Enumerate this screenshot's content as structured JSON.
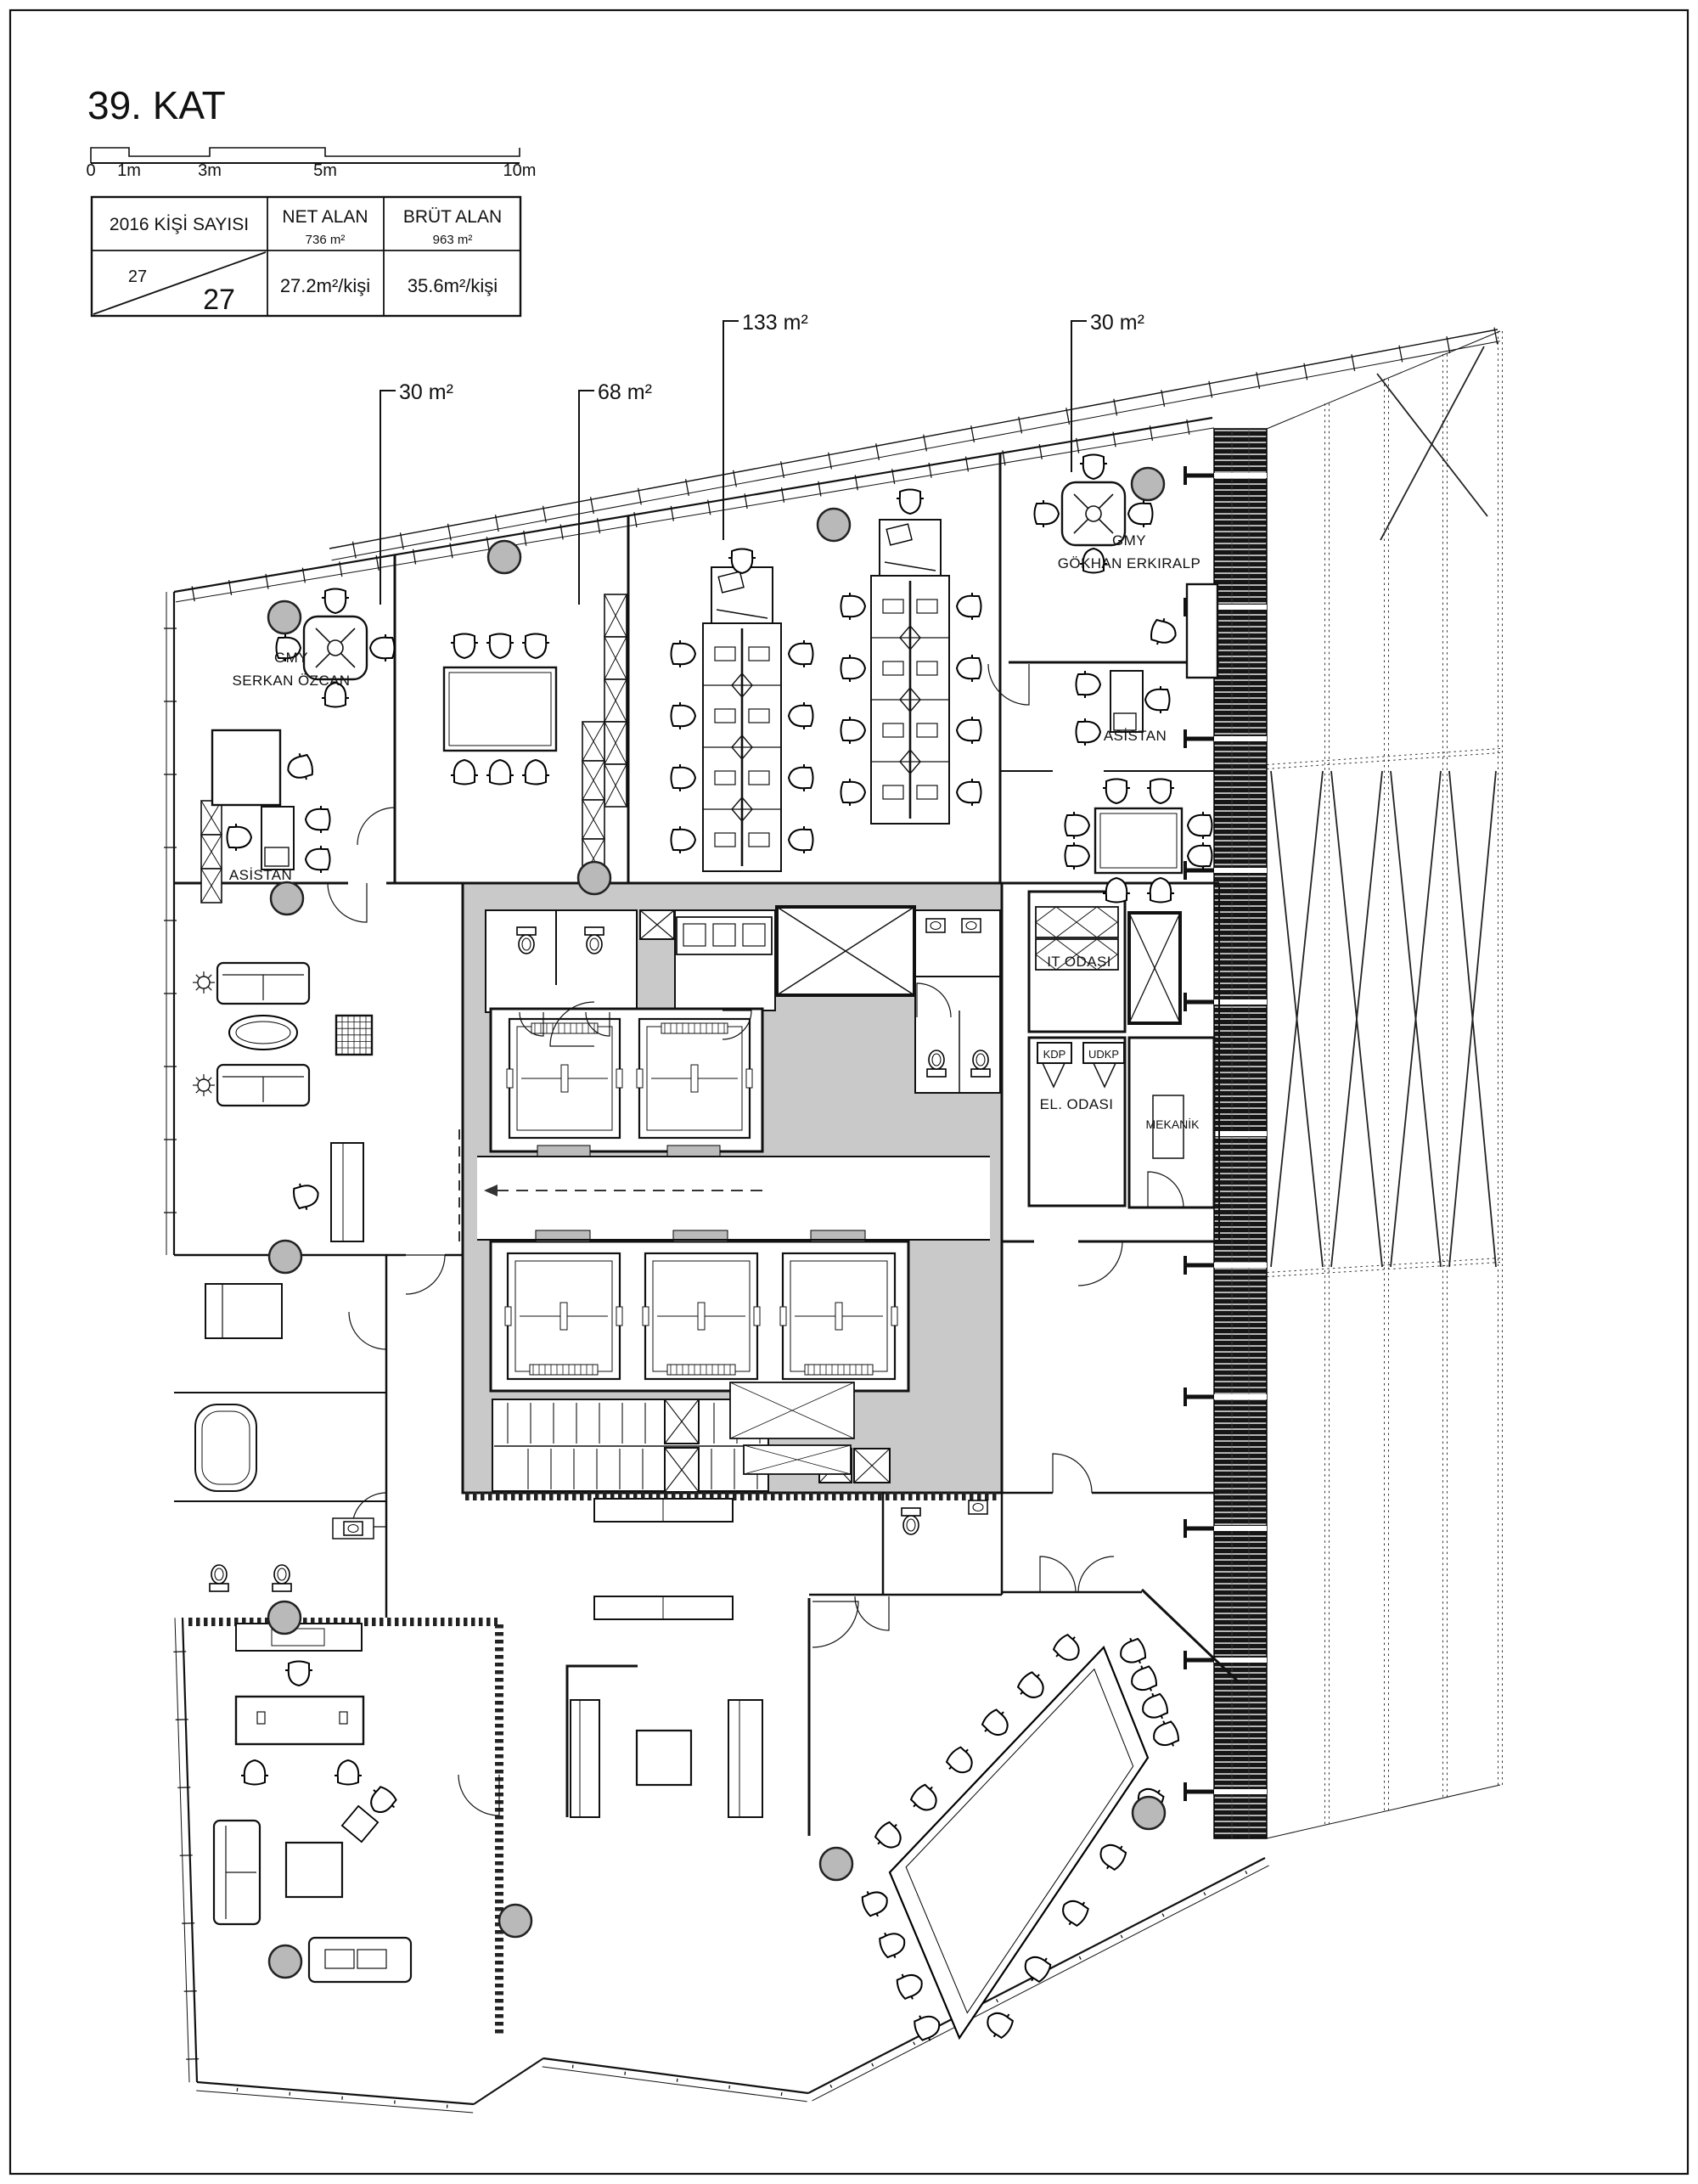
{
  "page": {
    "title": "39. KAT"
  },
  "scalebar": {
    "t0": "0",
    "t1": "1m",
    "t2": "3m",
    "t3": "5m",
    "t4": "10m"
  },
  "table": {
    "c1h": "2016 KİŞİ SAYISI",
    "c2h": "NET ALAN",
    "c2s": "736 m²",
    "c3h": "BRÜT ALAN",
    "c3s": "963 m²",
    "v1a": "27",
    "v1b": "27",
    "v2": "27.2m²/kişi",
    "v3": "35.6m²/kişi"
  },
  "areas": {
    "office_left": "30 m²",
    "meeting": "68 m²",
    "open_office": "133 m²",
    "office_right": "30 m²"
  },
  "rooms": {
    "gmy1a": "GMY",
    "gmy1b": "SERKAN ÖZCAN",
    "gmy2a": "GMY",
    "gmy2b": "GÖKHAN ERKIRALP",
    "asistan1": "ASİSTAN",
    "asistan2": "ASİSTAN",
    "it": "IT ODASI",
    "kdp": "KDP",
    "udkp": "UDKP",
    "el": "EL. ODASI",
    "mek": "MEKANİK"
  },
  "colors": {
    "line": "#111111",
    "column_fill": "#b9b9b9",
    "core_fill": "#c9c9c9",
    "hatch_dark": "#161616",
    "door_arc": "#222222",
    "dash": "#333333"
  }
}
